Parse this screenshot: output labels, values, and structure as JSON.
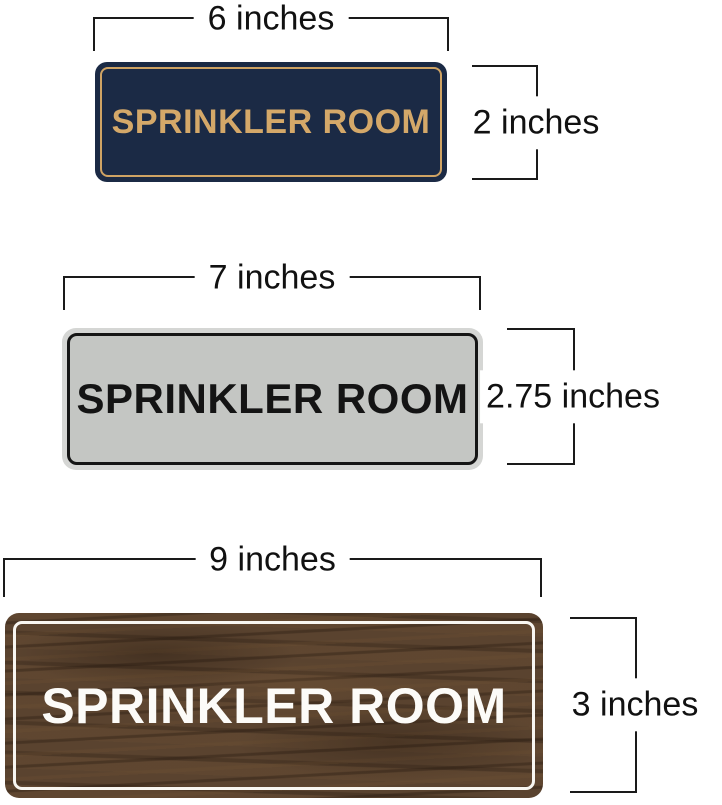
{
  "page": {
    "background": "#ffffff"
  },
  "dimension_line_color": "#1a1a1a",
  "signs": [
    {
      "id": "navy-gold-sign",
      "label": "SPRINKLER ROOM",
      "width_label": "6 inches",
      "height_label": "2 inches",
      "colors": {
        "background": "#1b2a45",
        "border": "#cfa364",
        "text": "#d4a869"
      }
    },
    {
      "id": "silver-black-sign",
      "label": "SPRINKLER ROOM",
      "width_label": "7 inches",
      "height_label": "2.75 inches",
      "colors": {
        "background": "#c4c6c3",
        "rim": "#d5d6d4",
        "border": "#151515",
        "text": "#141414"
      }
    },
    {
      "id": "walnut-white-sign",
      "label": "SPRINKLER ROOM",
      "width_label": "9 inches",
      "height_label": "3 inches",
      "colors": {
        "background": "#5a432f",
        "border": "#f8f6f1",
        "text": "#fcfbf8"
      }
    }
  ]
}
